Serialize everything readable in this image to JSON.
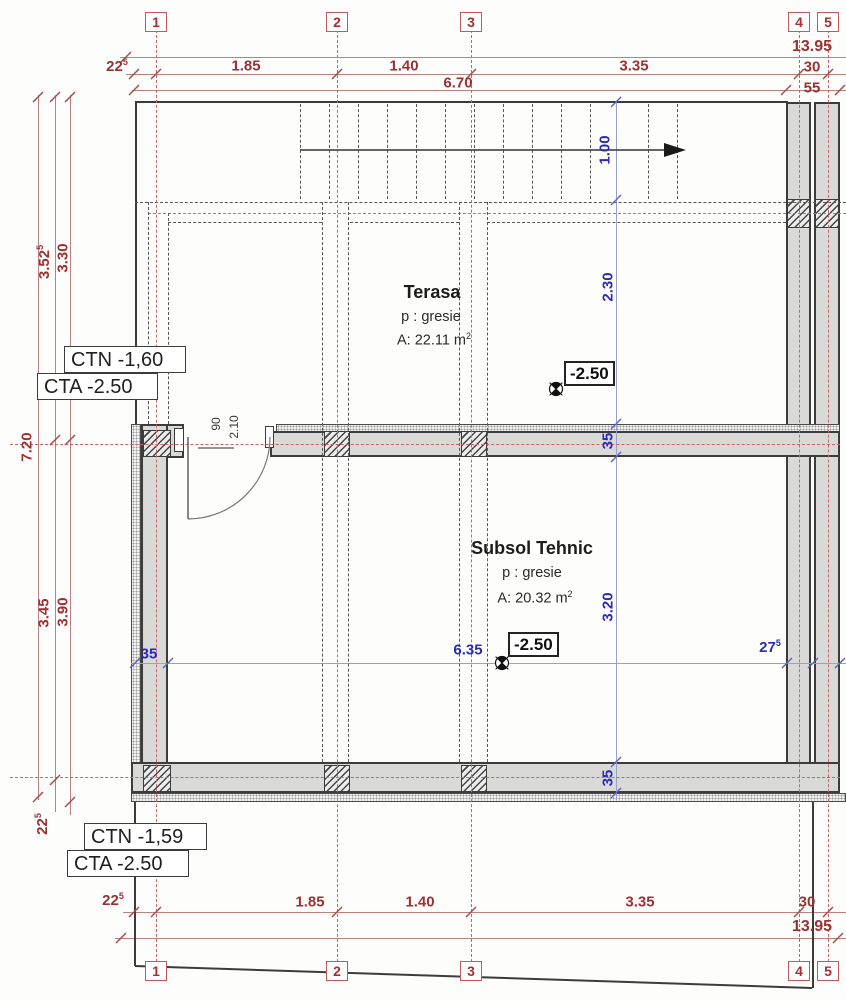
{
  "grid": {
    "b1": "1",
    "b2": "2",
    "b3": "3",
    "b4": "4",
    "b5": "5"
  },
  "top": {
    "overall": "13.95",
    "d22": "22",
    "d22s": "5",
    "d185": "1.85",
    "d140": "1.40",
    "d335": "3.35",
    "d30": "30",
    "d670": "6.70",
    "d55": "55"
  },
  "bottom": {
    "overall": "13.95",
    "d22": "22",
    "d22s": "5",
    "d185": "1.85",
    "d140": "1.40",
    "d335": "3.35",
    "d30": "30"
  },
  "left": {
    "v352": "3.52",
    "v352s": "5",
    "v330": "3.30",
    "v720": "7.20",
    "v345": "3.45",
    "v390": "3.90",
    "v225": "22",
    "v225s": "5"
  },
  "blue": {
    "stair_width": "1.00",
    "terasa_depth": "2.30",
    "wall_a": "35",
    "subsol_depth": "3.20",
    "wall_b": "35",
    "wall_left": "35",
    "span": "6.35",
    "wall_right": "27",
    "wall_right_s": "5"
  },
  "rooms": {
    "terasa": {
      "name": "Terasa",
      "finish": "p : gresie",
      "area": "A: 22.11 m",
      "area_sup": "2"
    },
    "subsol": {
      "name": "Subsol Tehnic",
      "finish": "p : gresie",
      "area": "A: 20.32 m",
      "area_sup": "2"
    }
  },
  "levels": {
    "terasa": "-2.50",
    "subsol": "-2.50"
  },
  "door": {
    "width": "90",
    "height": "2.10"
  },
  "notes": {
    "ctn_upper": "CTN -1,60",
    "cta_upper": "CTA -2.50",
    "ctn_lower": "CTN -1,59",
    "cta_lower": "CTA -2.50"
  }
}
